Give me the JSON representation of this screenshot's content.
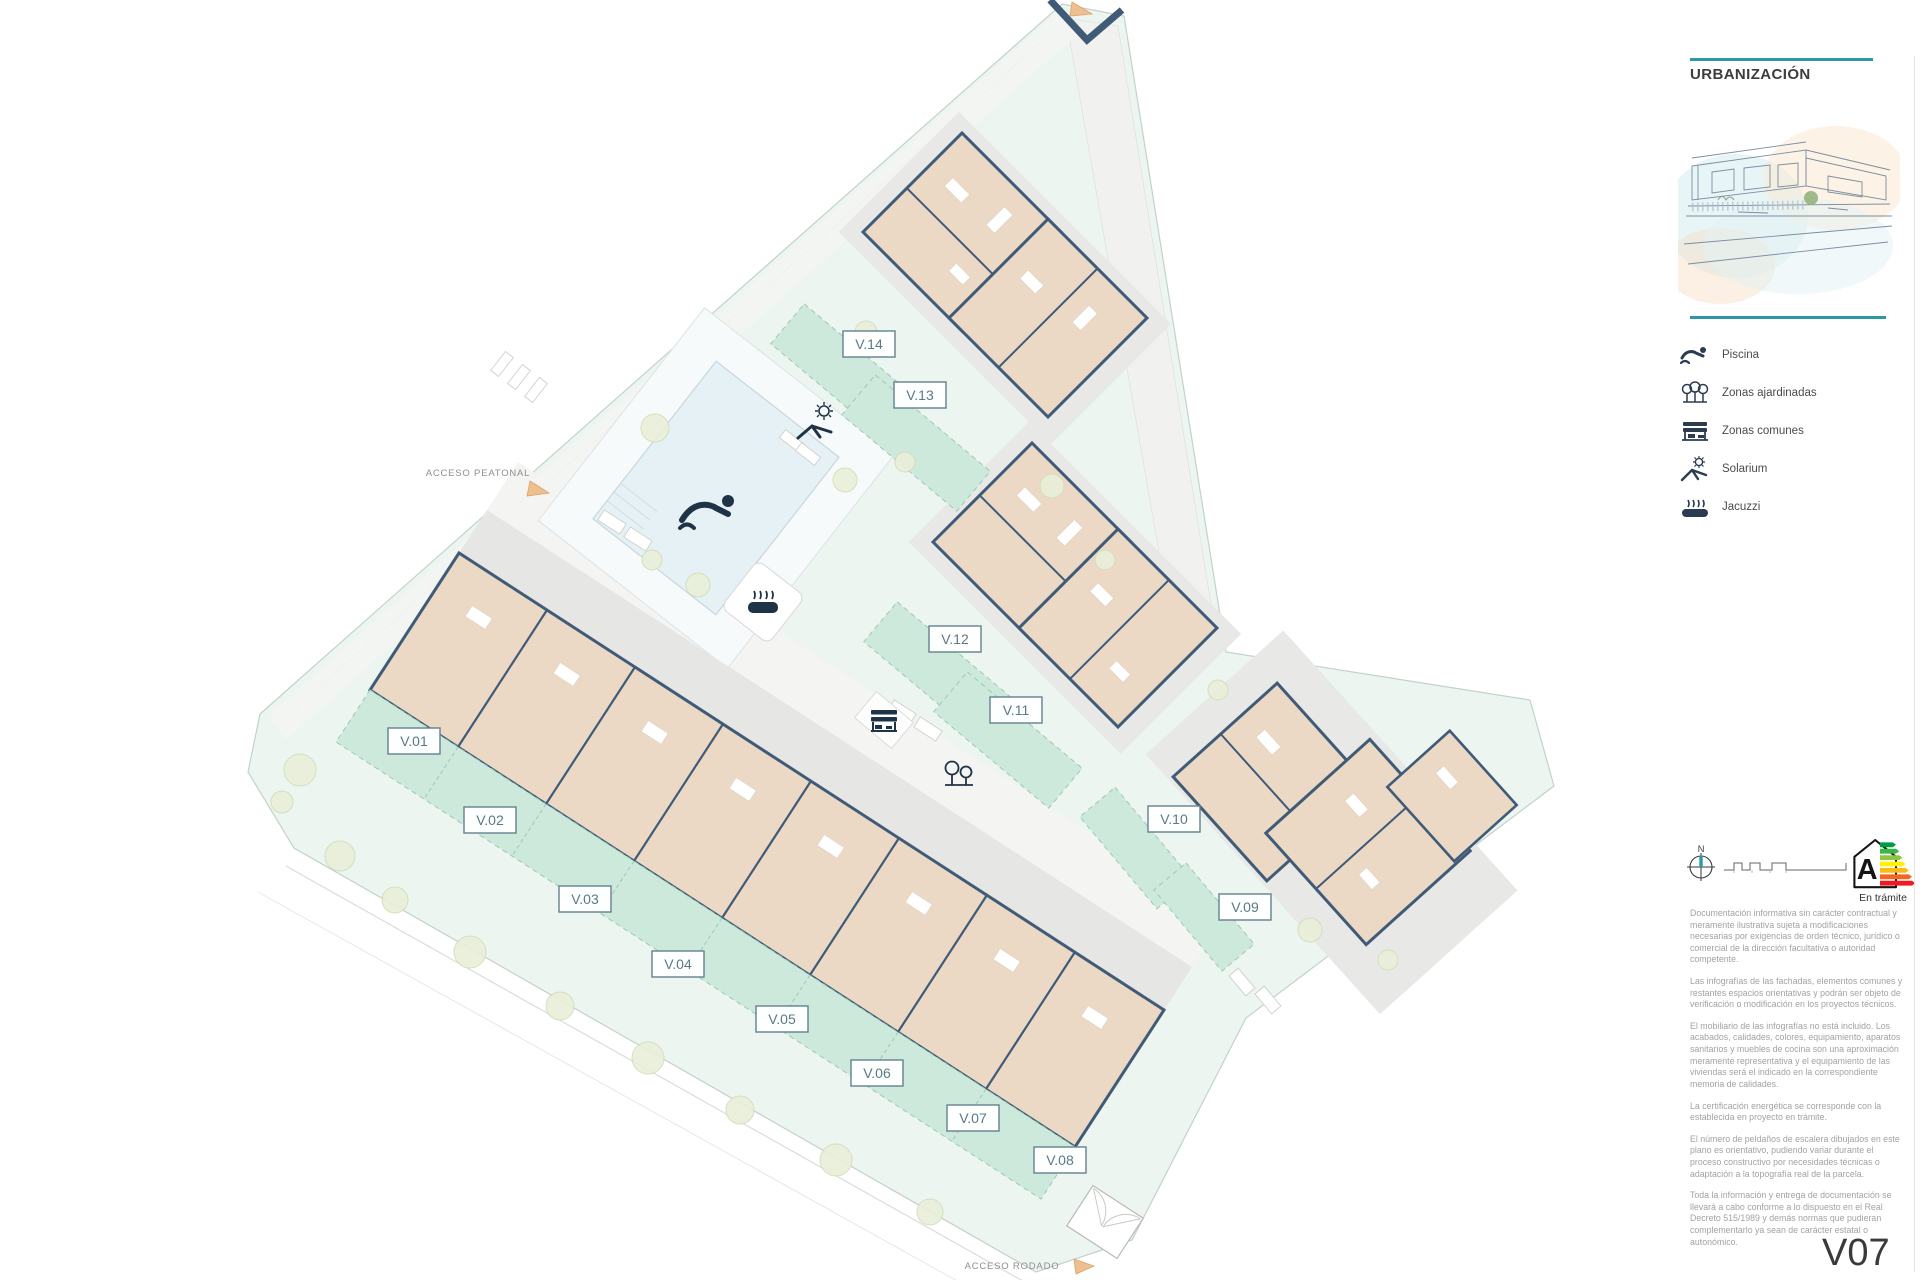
{
  "sidebar": {
    "title": "URBANIZACIÓN",
    "legend": [
      {
        "icon": "pool-icon",
        "label": "Piscina"
      },
      {
        "icon": "trees-icon",
        "label": "Zonas ajardinadas"
      },
      {
        "icon": "bench-icon",
        "label": "Zonas comunes"
      },
      {
        "icon": "sun-lounger-icon",
        "label": "Solarium"
      },
      {
        "icon": "jacuzzi-icon",
        "label": "Jacuzzi"
      }
    ],
    "compass_label": "N",
    "energy": {
      "letter": "A",
      "status": "En trámite"
    },
    "disclaimers": [
      "Documentación informativa sin carácter contractual y meramente ilustrativa sujeta a modificaciones necesarias por exigencias de orden técnico, jurídico o comercial de la dirección facultativa o autoridad competente.",
      "Las infografías de las fachadas, elementos comunes y restantes espacios orientativas y podrán ser objeto de verificación o modificación en los proyectos técnicos.",
      "El mobiliario de las infografías no está incluido. Los acabados, calidades, colores, equipamiento, aparatos sanitarios y muebles de cocina son una aproximación meramente representativa y el equipamiento de las viviendas será el indicado en la correspondiente memoria de calidades.",
      "La certificación energética se corresponde con la establecida en proyecto en trámite.",
      "El número de peldaños de escalera dibujados en este plano es orientativo, pudiendo variar durante el proceso constructivo por necesidades técnicas o adaptación a la topografía real de la parcela.",
      "Toda la información y entrega de documentación se llevará a cabo conforme a lo dispuesto en el Real Decreto 515/1989 y demás normas que pudieran complementarlo ya sean de carácter estatal o autonómico."
    ],
    "version": "V07"
  },
  "plan": {
    "units": [
      {
        "label": "V.01"
      },
      {
        "label": "V.02"
      },
      {
        "label": "V.03"
      },
      {
        "label": "V.04"
      },
      {
        "label": "V.05"
      },
      {
        "label": "V.06"
      },
      {
        "label": "V.07"
      },
      {
        "label": "V.08"
      },
      {
        "label": "V.09"
      },
      {
        "label": "V.10"
      },
      {
        "label": "V.11"
      },
      {
        "label": "V.12"
      },
      {
        "label": "V.13"
      },
      {
        "label": "V.14"
      }
    ],
    "access": {
      "pedestrian": "ACCESO PEATONAL",
      "road": "ACCESO RODADO"
    },
    "icons": [
      "pool-icon",
      "jacuzzi-icon",
      "bench-icon",
      "trees-icon",
      "sun-lounger-icon"
    ]
  },
  "colors": {
    "accent_teal": "#2f98a6",
    "building_fill": "#ecd9c5",
    "wall": "#3f5b77",
    "garden": "#cde9dc",
    "parcel": "#ecf5f0",
    "access_arrow": "#eec08f",
    "energy_scale": [
      "#009a44",
      "#39b54a",
      "#8dc63f",
      "#fff200",
      "#fdb913",
      "#f26522",
      "#ed1c24"
    ]
  }
}
